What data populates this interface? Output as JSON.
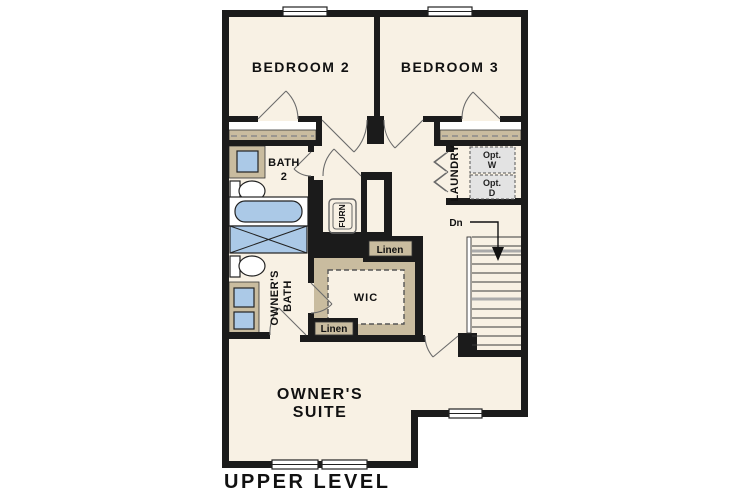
{
  "plan": {
    "title": "UPPER LEVEL",
    "labels": {
      "bedroom2": "BEDROOM 2",
      "bedroom3": "BEDROOM 3",
      "bath2_l1": "BATH",
      "bath2_l2": "2",
      "owners_bath_l1": "OWNER'S",
      "owners_bath_l2": "BATH",
      "owners_suite_l1": "OWNER'S",
      "owners_suite_l2": "SUITE",
      "wic": "WIC",
      "laundry": "LAUNDRY",
      "furnace": "FURN",
      "linen_top": "Linen",
      "linen_bottom": "Linen",
      "stairs_down": "Dn",
      "opt_washer_l1": "Opt.",
      "opt_washer_l2": "W",
      "opt_dryer_l1": "Opt.",
      "opt_dryer_l2": "D"
    },
    "colors": {
      "background": "#ffffff",
      "floor": "#f8f1e4",
      "wall": "#1b1b1b",
      "casework_tan": "#c9bc9f",
      "fixture_blue": "#abc9e7",
      "appliance_gray": "#e3e3e3"
    }
  }
}
